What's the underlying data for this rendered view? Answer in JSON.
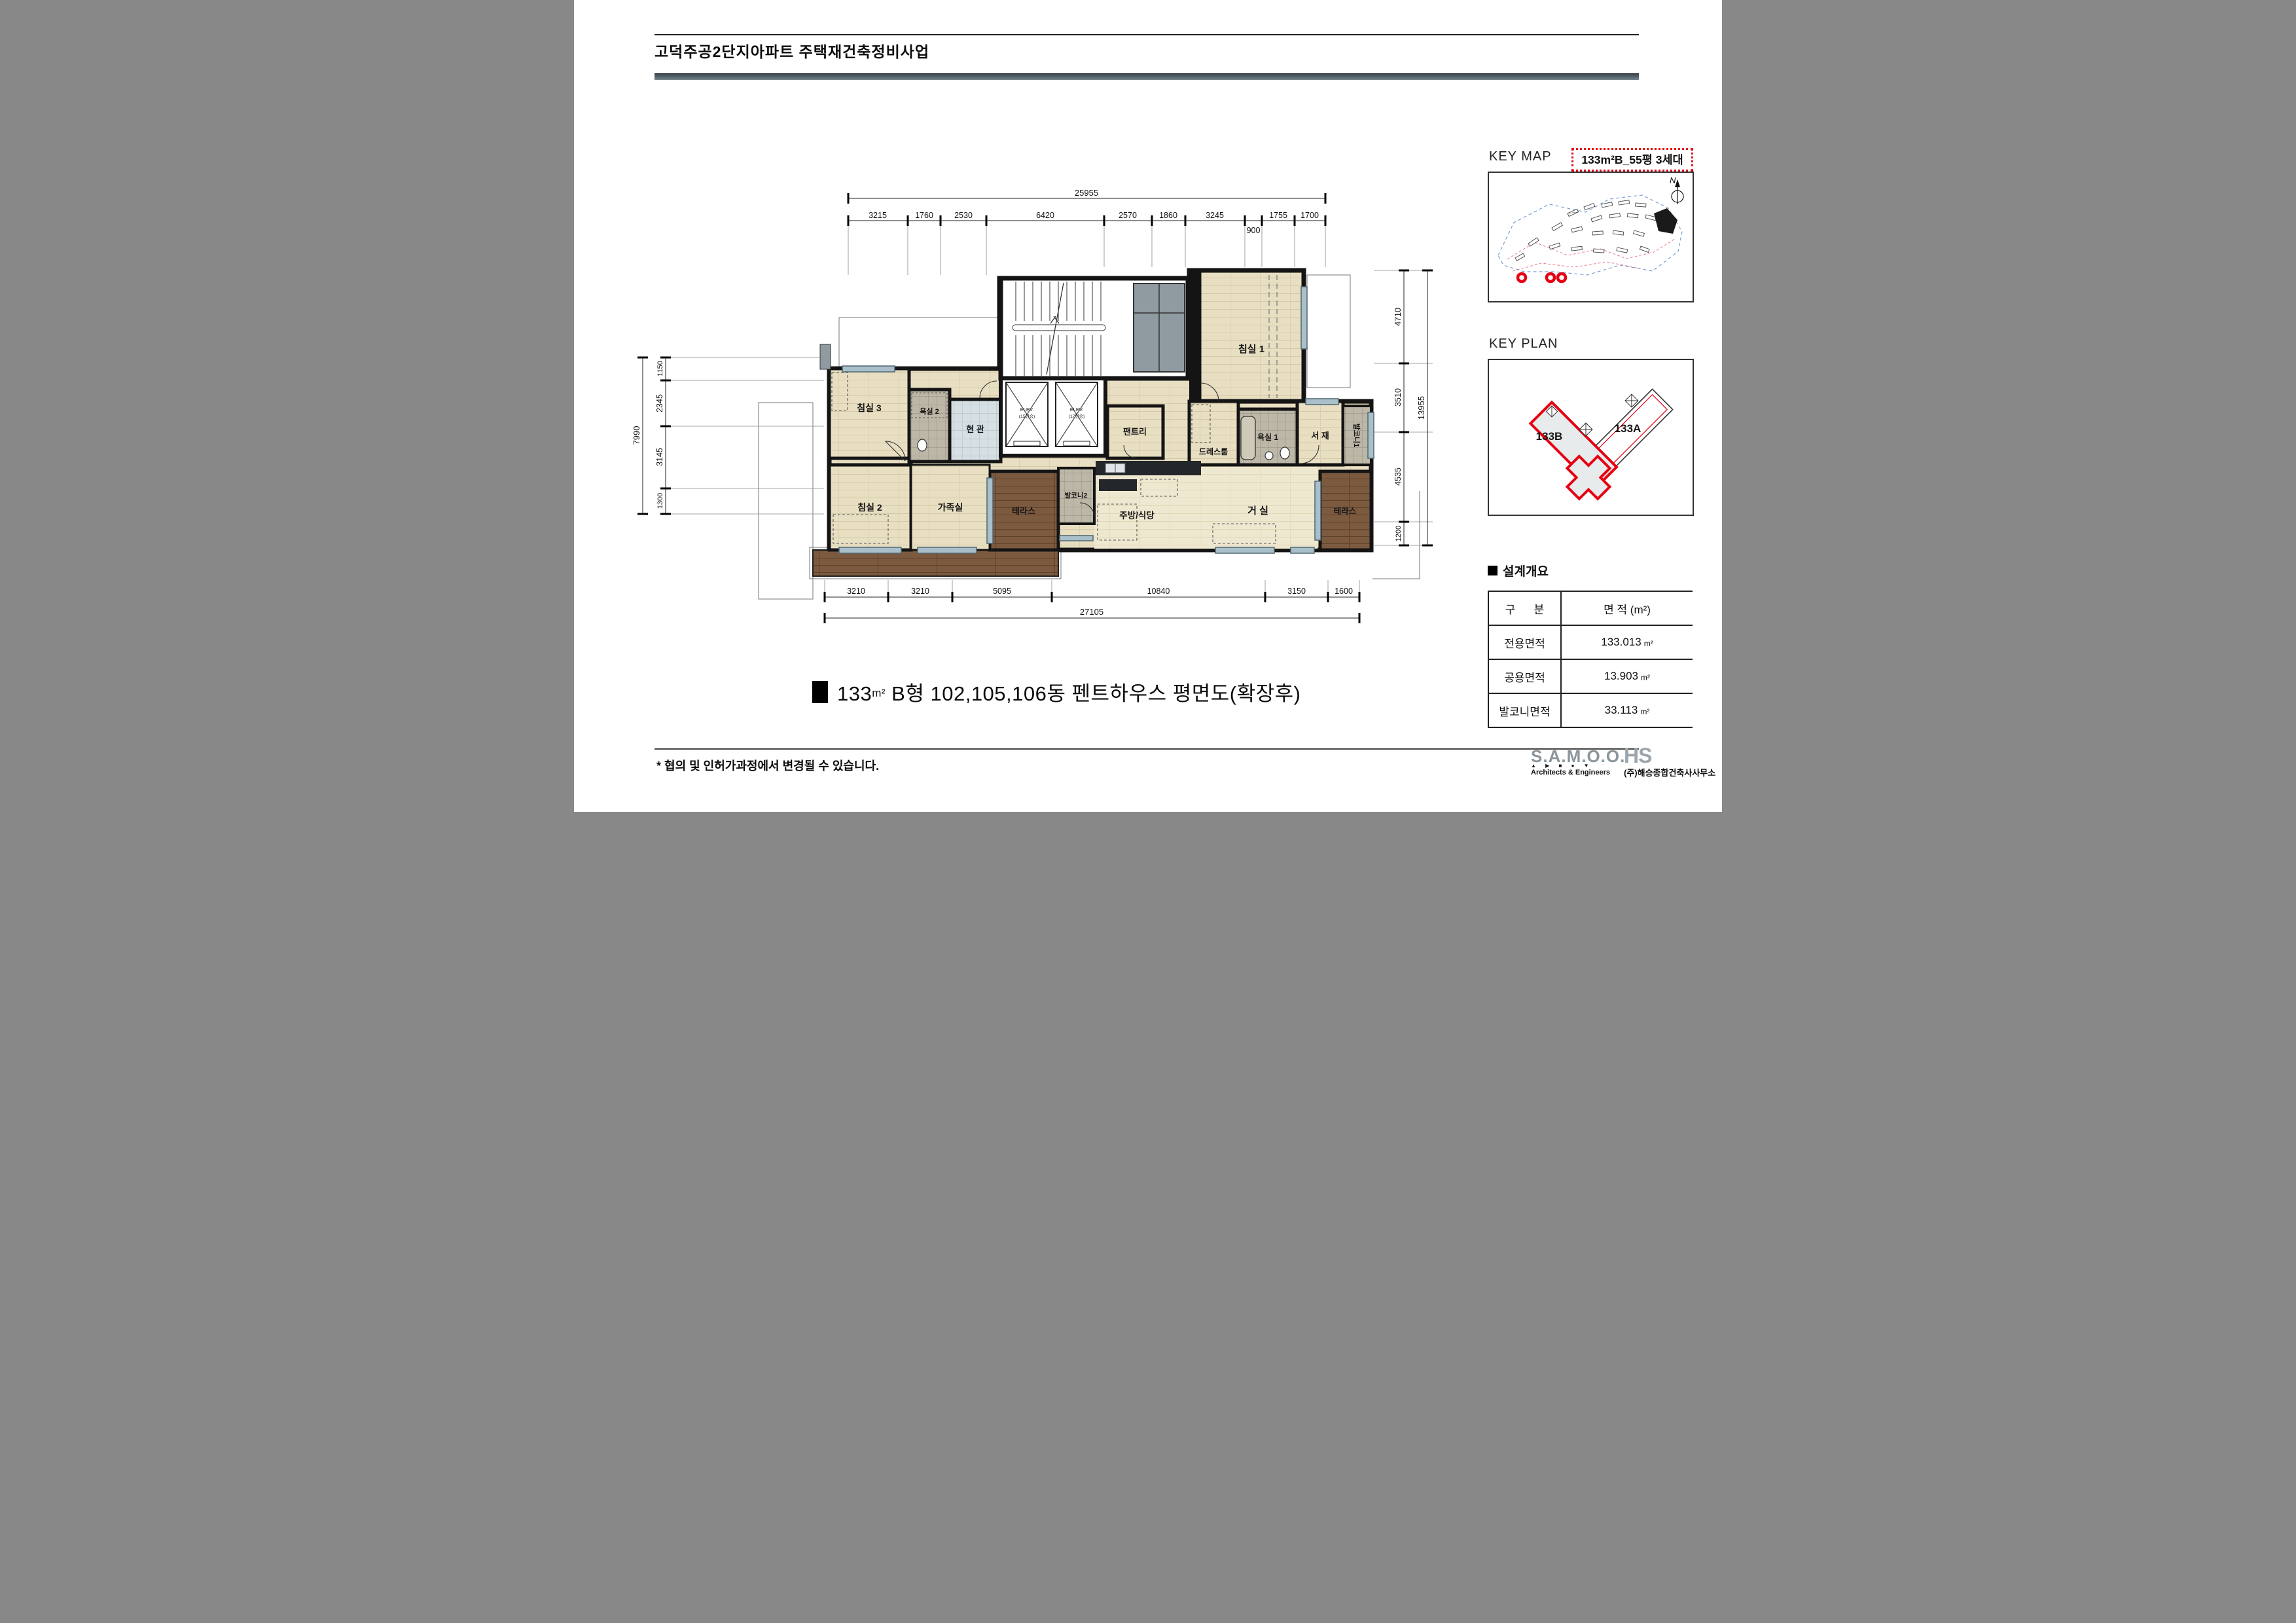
{
  "header": {
    "title": "고덕주공2단지아파트 주택재건축정비사업"
  },
  "key_map": {
    "title": "KEY MAP",
    "unit_tag": "133m²B_55평 3세대",
    "north": "N"
  },
  "key_plan": {
    "title": "KEY PLAN",
    "block_b": "133B",
    "block_a": "133A"
  },
  "summary": {
    "title": "설계개요",
    "col1": "구      분",
    "col2": "면 적 (m²)",
    "rows": [
      {
        "label": "전용면적",
        "value": "133.013",
        "unit": "m²"
      },
      {
        "label": "공용면적",
        "value": "13.903",
        "unit": "m²"
      },
      {
        "label": "발코니면적",
        "value": "33.113",
        "unit": "m²"
      }
    ]
  },
  "caption": {
    "prefix": "133",
    "unit": "m²",
    "rest": " B형 102,105,106동 펜트하우스 평면도(확장후)"
  },
  "footnote": "* 협의 및 인허가과정에서 변경될 수 있습니다.",
  "footer_logos": {
    "samoo": "S.A.M.O.O.",
    "samoo_tri": "▲ ▶ ■ ● ▼",
    "samoo_sub": "Architects & Engineers",
    "hs": "HS",
    "firm": "(주)해승종합건축사사무소"
  },
  "plan": {
    "rooms": {
      "bedroom1": "침실 1",
      "dress": "드레스룸",
      "bath1": "욕실 1",
      "study": "서 재",
      "balcony1": "발코니1",
      "pantry": "팬트리",
      "entry": "현 관",
      "bath2": "욕실 2",
      "bedroom3": "침실 3",
      "bedroom2": "침실 2",
      "family": "가족실",
      "terrace_left": "테라스",
      "balcony2": "발코니2",
      "kitchen": "주방/식당",
      "living": "거 실",
      "terrace_right": "테라스"
    },
    "elevators": {
      "label": "ELEV.",
      "cap15": "(15인승)",
      "cap17": "(17인승)"
    },
    "dims": {
      "top": {
        "total": "25955",
        "sub": "900",
        "segments": [
          "3215",
          "1760",
          "2530",
          "6420",
          "2570",
          "1860",
          "3245",
          "1755",
          "1700"
        ]
      },
      "bottom": {
        "total": "27105",
        "segments": [
          "3210",
          "3210",
          "5095",
          "10840",
          "3150",
          "1600"
        ]
      },
      "left": {
        "total": "7990",
        "segments": [
          "1150",
          "2345",
          "3145",
          "1300"
        ]
      },
      "right": {
        "total": "13955",
        "segments": [
          "4710",
          "3510",
          "4535",
          "1200"
        ]
      }
    }
  },
  "colors": {
    "accent_red": "#e60012",
    "wall": "#141414",
    "wood": "#e8dfc3",
    "deck": "#7c5a40",
    "header_bar": "#5d6d75"
  }
}
